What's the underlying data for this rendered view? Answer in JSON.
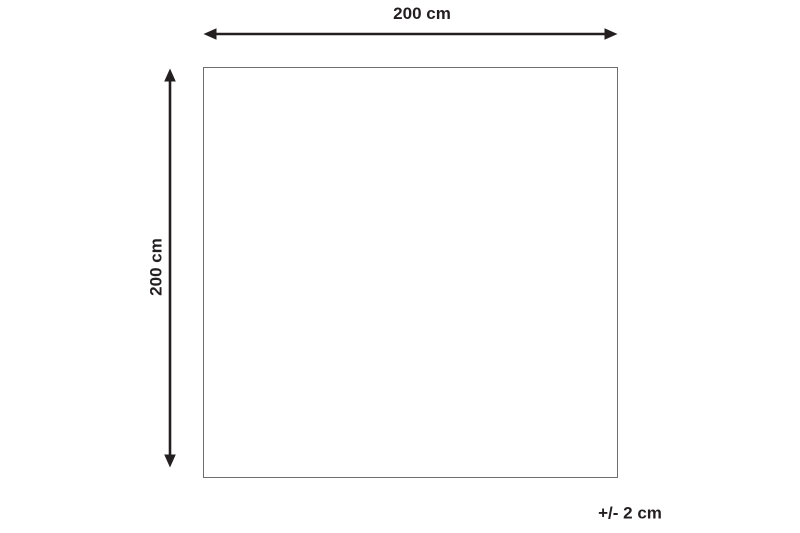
{
  "diagram": {
    "width_label": "200 cm",
    "height_label": "200 cm",
    "tolerance_label": "+/- 2 cm",
    "colors": {
      "arrow_and_text": "#231f20",
      "square_border": "#6d6e70",
      "background": "#ffffff"
    }
  }
}
